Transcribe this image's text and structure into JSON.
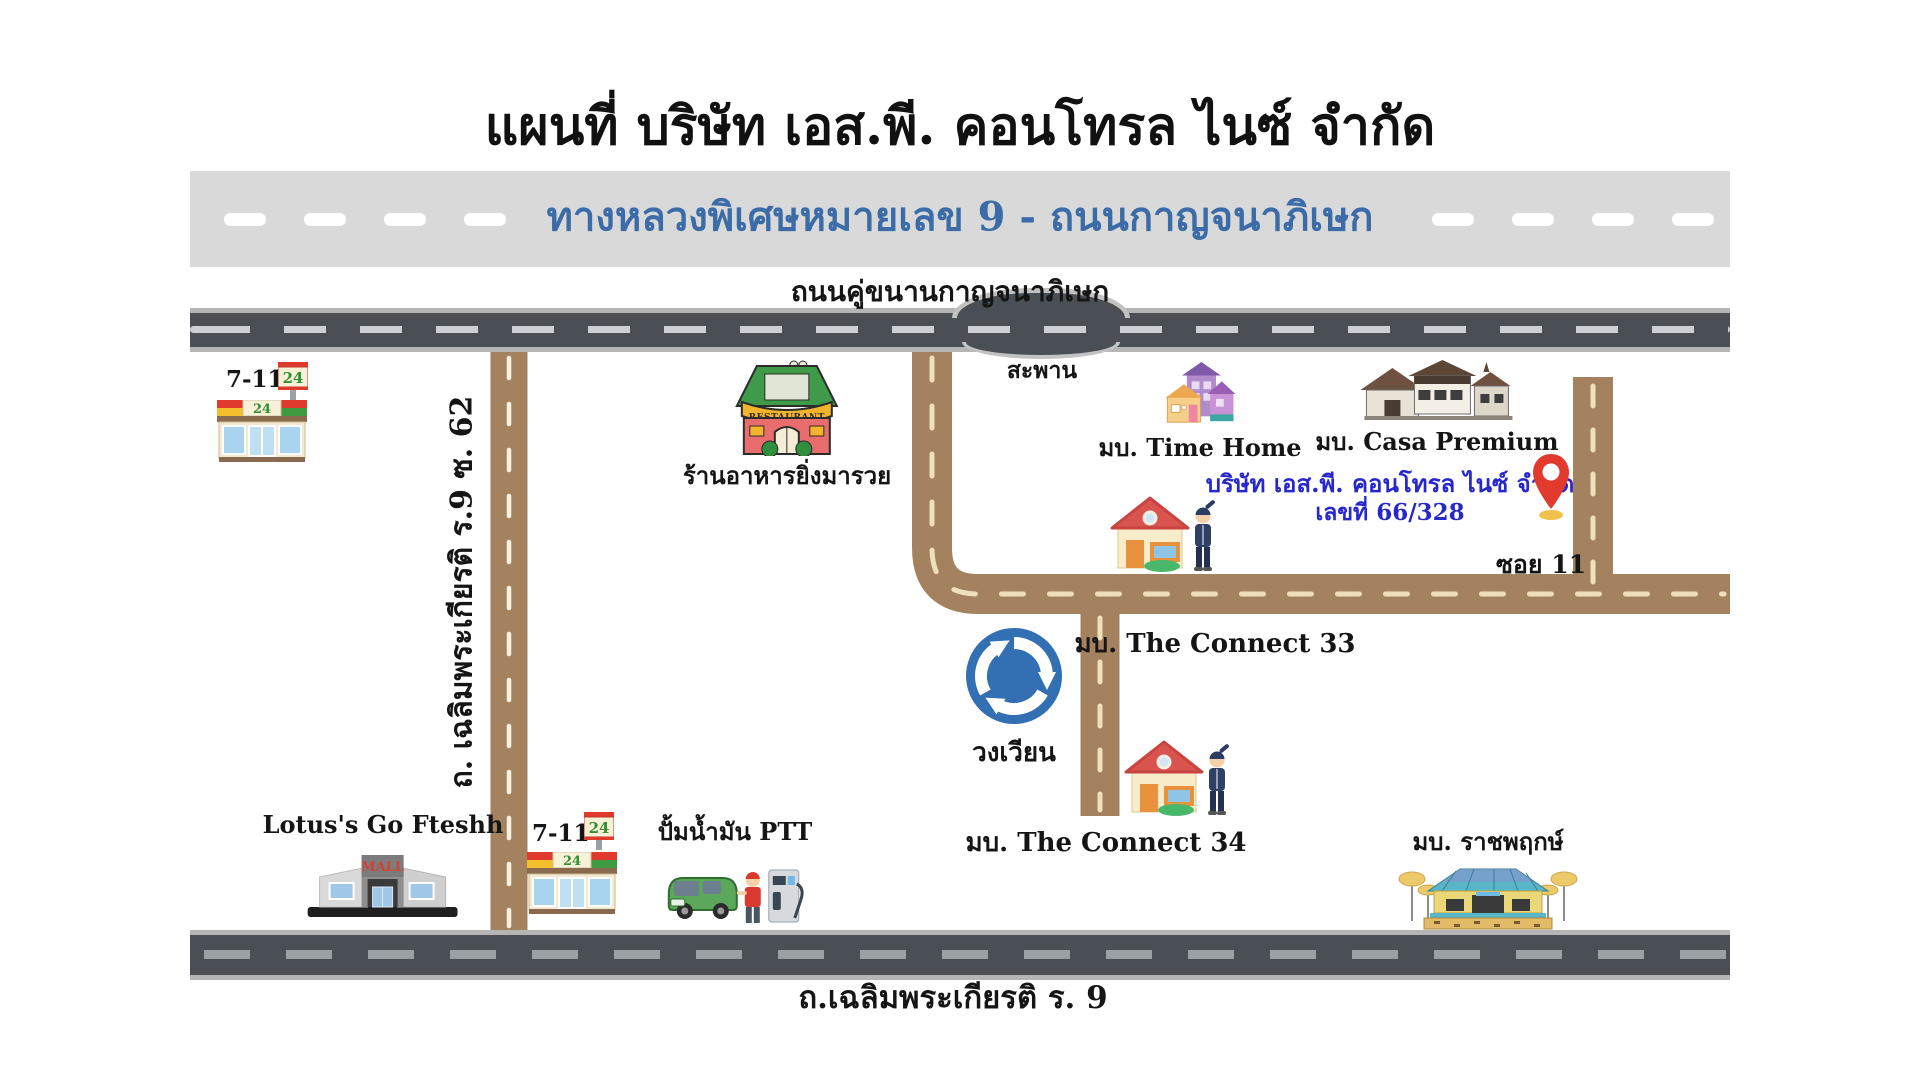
{
  "title": "แผนที่ บริษัท เอส.พี. คอนโทรล ไนซ์ จำกัด",
  "highway_band": {
    "label": "ทางหลวงพิเศษหมายเลข 9 - ถนนกาญจนาภิเษก"
  },
  "roads": {
    "parallel": "ถนนคู่ขนานกาญจนาภิเษก",
    "bridge": "สะพาน",
    "soi62": "ถ. เฉลิมพระเกียรติ ร.9 ซ. 62",
    "soi11": "ซอย 11",
    "bottom": "ถ.เฉลิมพระเกียรติ ร. 9"
  },
  "places": {
    "seven_eleven_top": {
      "label": "7-11",
      "pole_sign": "24",
      "awning_sign": "24"
    },
    "restaurant": {
      "label": "ร้านอาหารยิ่งมารวย",
      "banner": "RESTAURANT"
    },
    "time_home": {
      "label": "มบ. Time Home"
    },
    "casa_premium": {
      "label": "มบ. Casa Premium"
    },
    "company": {
      "name": "บริษัท เอส.พี. คอนโทรล ไนซ์ จำกัด",
      "address": "เลขที่ 66/328"
    },
    "connect_33": {
      "label": "มบ. The Connect 33"
    },
    "roundabout": {
      "label": "วงเวียน"
    },
    "connect_34": {
      "label": "มบ. The Connect 34"
    },
    "lotus": {
      "label": "Lotus's Go Fteshh",
      "sign": "MALL"
    },
    "seven_eleven_bottom": {
      "label": "7-11",
      "pole_sign": "24",
      "awning_sign": "24"
    },
    "ptt": {
      "label": "ปั้มน้ำมัน PTT"
    },
    "ratchaphruek": {
      "label": "มบ. ราชพฤกษ์"
    }
  },
  "colors": {
    "highway_band_bg": "#d9d9d9",
    "highway_text": "#3c6ca8",
    "road_dark": "#4a4f55",
    "road_brown": "#a5825f",
    "company_text": "#2727cc",
    "pin_red": "#e23b2e",
    "roundabout_blue": "#3270b3"
  }
}
